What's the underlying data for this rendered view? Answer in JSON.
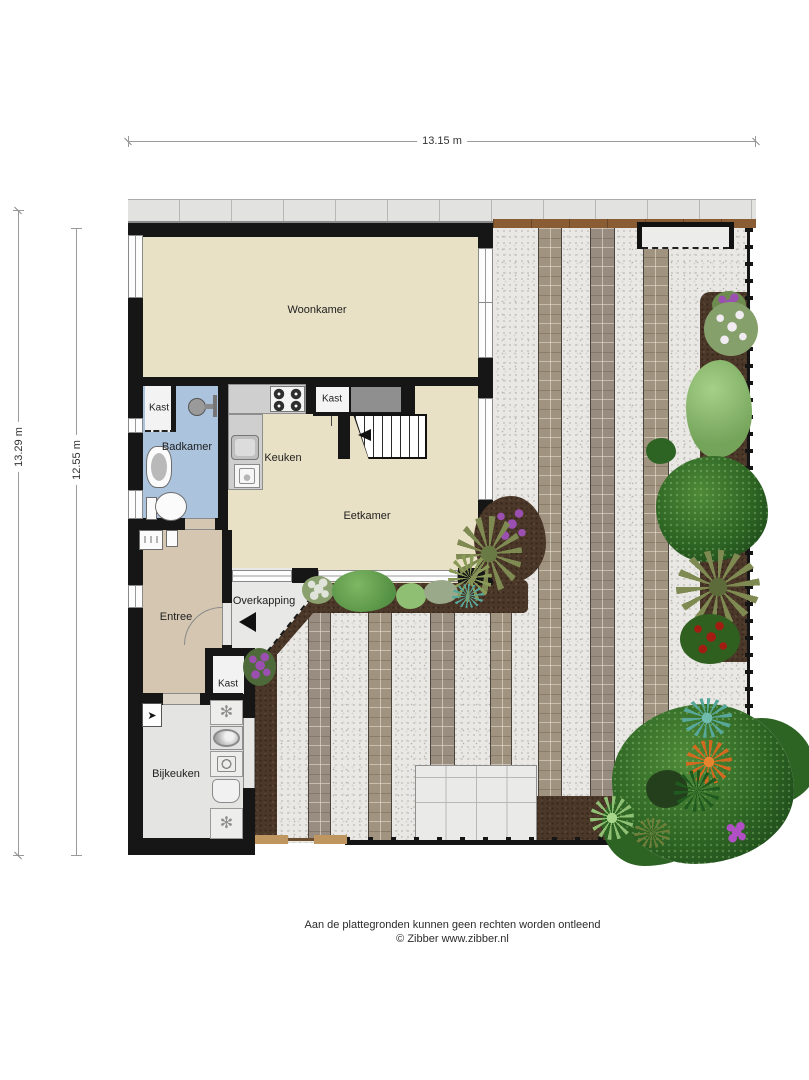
{
  "dimensions": {
    "top": "13.15 m",
    "left_outer": "13.29 m",
    "left_inner": "12.55 m"
  },
  "rooms": {
    "woonkamer": "Woonkamer",
    "kast_top": "Kast",
    "badkamer": "Badkamer",
    "keuken": "Keuken",
    "kast_mid": "Kast",
    "eetkamer": "Eetkamer",
    "entree": "Entree",
    "overkapping": "Overkapping",
    "kast_entree": "Kast",
    "bijkeuken": "Bijkeuken"
  },
  "footer": {
    "line1": "Aan de plattegronden kunnen geen rechten worden ontleend",
    "line2": "© Zibber www.zibber.nl"
  },
  "icons": {
    "freezer": "✻",
    "vent": "➤"
  },
  "colors": {
    "wall": "#161616",
    "floor": "#e9e1c5",
    "bathroom": "#abc3dd",
    "entree": "#d5c6b2",
    "utility": "#e4e4e3",
    "overkap": "#e8e8e6",
    "counter": "#cfcfcf",
    "gravel": "#e9e8e5",
    "brick": "#a0937f",
    "soil": "#4c3828",
    "treec": "#2d6423",
    "fencewood": "#8a5c33",
    "gatewood": "#bf9660",
    "sidewalk": "#e2e2e0",
    "purple": "#9b4fb0",
    "teal": "#57a79a",
    "orange": "#d2691e",
    "redf": "#a31c12",
    "whitef": "#f1ecf1",
    "olive": "#7e8a52",
    "greenbush": "#559144",
    "lightgreen": "#8fbf72"
  }
}
